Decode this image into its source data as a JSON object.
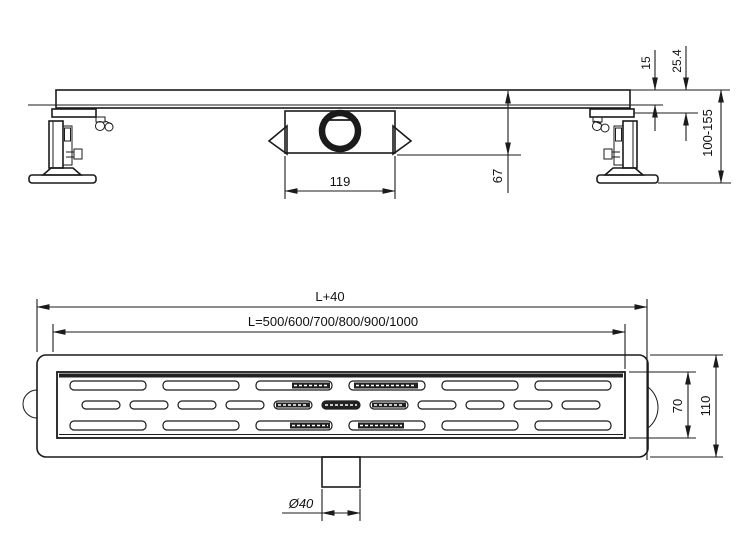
{
  "drawing": {
    "background": "#ffffff",
    "line_color": "#1b1b1b",
    "side_view": {
      "dim_trap_length": "119",
      "dim_channel_depth": "67",
      "dim_grate_edge_height": "15",
      "dim_flange_height": "25.4",
      "dim_adjustable_height": "100-155"
    },
    "plan_view": {
      "dim_overall_length": "L+40",
      "dim_length_options": "L=500/600/700/800/900/1000",
      "dim_outlet_diameter": "Ø40",
      "dim_grate_width": "70",
      "dim_body_width": "110"
    }
  }
}
